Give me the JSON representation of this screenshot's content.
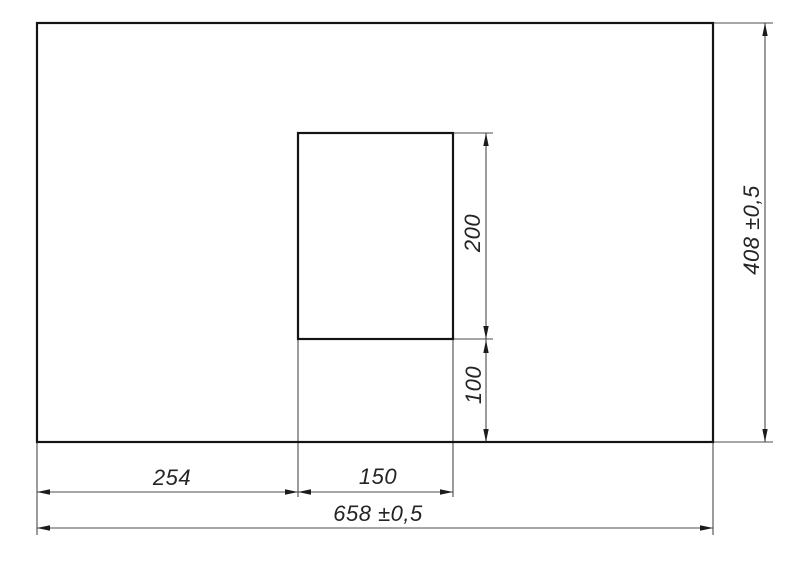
{
  "drawing": {
    "canvas": {
      "width": 800,
      "height": 577,
      "background": "#ffffff"
    },
    "colors": {
      "outline": "#141414",
      "thin_line": "#4c4c4c",
      "arrow": "#1c1c1c",
      "text": "#242424"
    },
    "plate_outline": {
      "x": 37,
      "y": 23,
      "width": 676,
      "height": 419
    },
    "cutout_outline": {
      "x": 298,
      "y": 133,
      "width": 155,
      "height": 206
    },
    "extension_lines": [
      [
        713,
        23,
        773,
        23
      ],
      [
        713,
        442,
        773,
        442
      ],
      [
        37,
        442,
        37,
        535
      ],
      [
        713,
        442,
        713,
        535
      ],
      [
        298,
        339,
        298,
        497
      ],
      [
        453,
        339,
        453,
        497
      ],
      [
        453,
        133,
        493,
        133
      ],
      [
        453,
        339,
        493,
        339
      ]
    ],
    "dimension_lines": [
      {
        "name": "offset-left",
        "x1": 37,
        "y1": 492,
        "x2": 298,
        "y2": 492,
        "arrows": [
          {
            "x": 37,
            "y": 492,
            "dir": "left"
          },
          {
            "x": 298,
            "y": 492,
            "dir": "right"
          }
        ]
      },
      {
        "name": "cutout-width",
        "x1": 298,
        "y1": 492,
        "x2": 453,
        "y2": 492,
        "arrows": [
          {
            "x": 298,
            "y": 492,
            "dir": "left"
          },
          {
            "x": 453,
            "y": 492,
            "dir": "right"
          }
        ]
      },
      {
        "name": "total-width",
        "x1": 37,
        "y1": 528,
        "x2": 713,
        "y2": 528,
        "arrows": [
          {
            "x": 37,
            "y": 528,
            "dir": "left"
          },
          {
            "x": 713,
            "y": 528,
            "dir": "right"
          }
        ]
      },
      {
        "name": "cutout-height",
        "x1": 486,
        "y1": 133,
        "x2": 486,
        "y2": 339,
        "arrows": [
          {
            "x": 486,
            "y": 133,
            "dir": "up"
          },
          {
            "x": 486,
            "y": 339,
            "dir": "down"
          }
        ]
      },
      {
        "name": "offset-bottom",
        "x1": 486,
        "y1": 339,
        "x2": 486,
        "y2": 442,
        "arrows": [
          {
            "x": 486,
            "y": 340,
            "dir": "up"
          },
          {
            "x": 486,
            "y": 442,
            "dir": "down"
          }
        ]
      },
      {
        "name": "total-height",
        "x1": 765,
        "y1": 23,
        "x2": 765,
        "y2": 442,
        "arrows": [
          {
            "x": 765,
            "y": 23,
            "dir": "up"
          },
          {
            "x": 765,
            "y": 442,
            "dir": "down"
          }
        ]
      }
    ]
  },
  "labels": {
    "offset_left": "254",
    "cutout_width": "150",
    "total_width": "658 ±0,5",
    "cutout_height": "200",
    "offset_bottom": "100",
    "total_height": "408 ±0,5"
  }
}
